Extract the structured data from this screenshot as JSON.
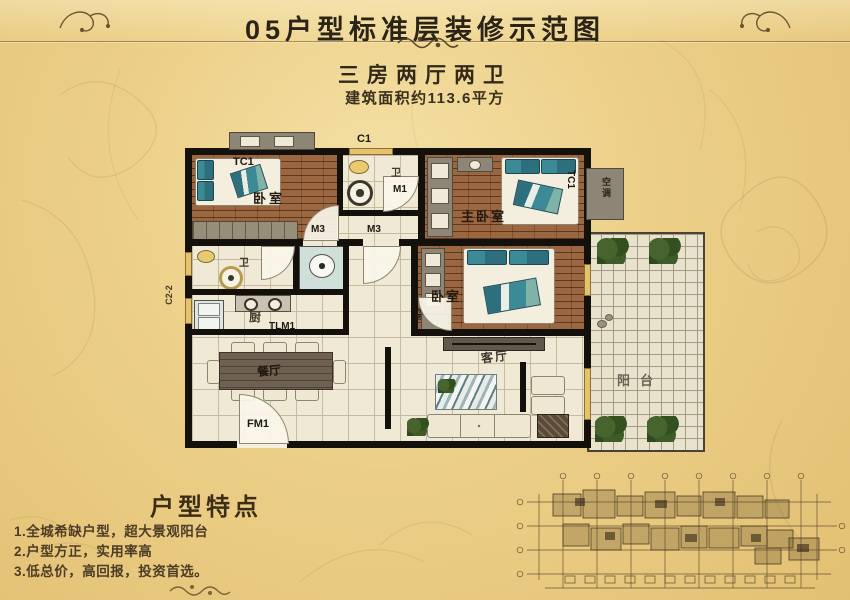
{
  "header": {
    "title": "05户型标准层装修示范图",
    "subtitle": "三房两厅两卫",
    "area_text": "建筑面积约113.6平方"
  },
  "plan": {
    "bedroom1_label": "卧室",
    "master_label": "主卧室",
    "bedroom2_label": "卧室",
    "bath1_label": "卫",
    "bath2_label": "卫",
    "kitchen_label": "厨",
    "dining_label": "餐厅",
    "living_label": "客厅",
    "balcony_label": "阳台",
    "ac_label": "空调",
    "code_tc1_bedroom1": "TC1",
    "code_tc1_master": "TC1",
    "code_c1": "C1",
    "code_m1": "M1",
    "code_m3_a": "M3",
    "code_m3_b": "M3",
    "code_m3_c": "M3",
    "code_tlm1": "TLM1",
    "code_fm1": "FM1",
    "code_c2_2": "C2-2"
  },
  "features": {
    "title": "户型特点",
    "items": [
      "1.全城希缺户型，超大景观阳台",
      "2.户型方正，实用率高",
      "3.低总价，高回报，投资首选。"
    ]
  },
  "colors": {
    "background": "#eccf87",
    "title_text": "#2b2315",
    "wall": "#14100b",
    "wood_floor": "#8a5531",
    "tile_floor": "#f0e9d6",
    "bedding_teal": "#2e6f7e",
    "plant_green": "#3d5c2a",
    "window_yellow": "#e6c36a"
  }
}
